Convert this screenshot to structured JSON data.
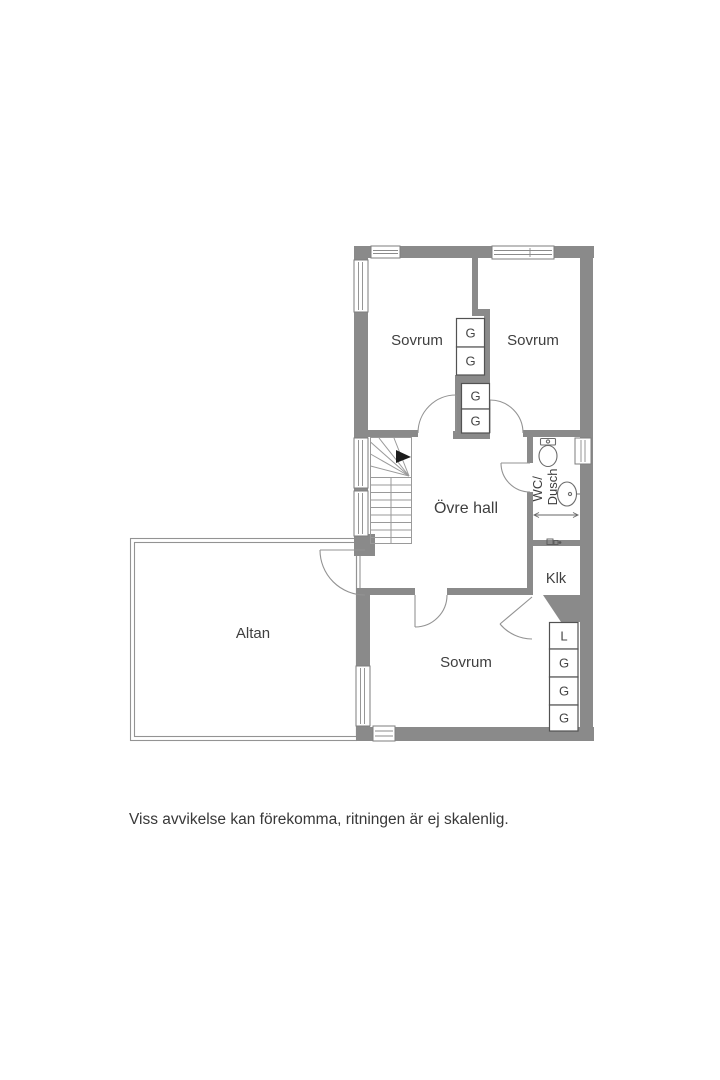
{
  "plan": {
    "rooms": {
      "bedroom_top_left": "Sovrum",
      "bedroom_top_right": "Sovrum",
      "upper_hall": "Övre hall",
      "wc_line1": "WC/",
      "wc_line2": "Dusch",
      "klk": "Klk",
      "bedroom_bottom": "Sovrum",
      "altan": "Altan"
    },
    "wardrobes_central": [
      "G",
      "G",
      "G",
      "G"
    ],
    "wardrobes_right": [
      "L",
      "G",
      "G",
      "G"
    ],
    "colors": {
      "wall": "#8a8a8a",
      "thin_line": "#939393",
      "label_text": "#3f3f3f",
      "background": "#ffffff"
    }
  },
  "footer": {
    "disclaimer": "Viss avvikelse kan förekomma, ritningen är ej skalenlig."
  }
}
